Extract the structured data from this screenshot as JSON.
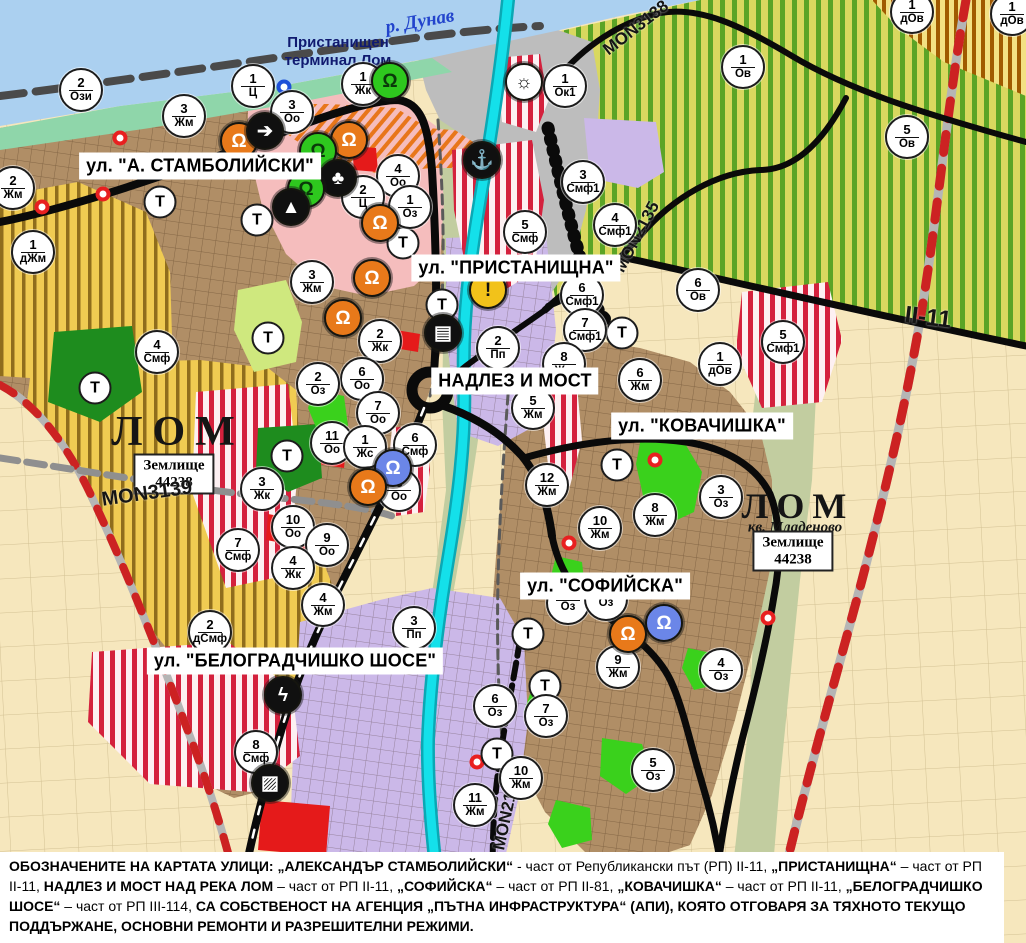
{
  "colors": {
    "base-field": "#f6e7bd",
    "town-brown": "#b08e66",
    "yellow-zone": "#f0cb52",
    "yellow-stripe": "#8f6d1c",
    "vineyard": "#d9d85f",
    "vine-stripe": "#5ba426",
    "brown-zone-bg": "#f3e083",
    "brown-stripe": "#a05a00",
    "pink-zone": "#f5bdbd",
    "orange": "#e8761a",
    "red-zone": "#e51a1a",
    "red-stripe-bg": "#fdf0f2",
    "red-stripe": "#d4213d",
    "lavender": "#cbb8e8",
    "gray-zone": "#bdbdbd",
    "green-dark": "#1e8c1e",
    "green-bright": "#3ad11c",
    "green-light": "#cfe87e",
    "shore": "#8fd6aa",
    "danube": "#abd0f0",
    "valley": "#c2cda0",
    "river-cyan": "#14e0ea",
    "river-teal": "#0aa8b4",
    "road-black": "#0a0a0a",
    "rail-gray": "#b5b5b5",
    "rail-red": "#cc2222",
    "dash-gray": "#8f8f8f",
    "boundary-gray": "#5a5a5a",
    "marker-red": "#e82020",
    "marker-blue": "#1e50d8",
    "danube-text": "#2244cc",
    "port-text": "#101a70"
  },
  "labels": {
    "river": "р. Дунав",
    "port_terminal": "Пристанищен терминал Лом",
    "lom_left": "ЛОМ",
    "lom_right": "ЛОМ",
    "kv_mladenovo": "кв. Младеново",
    "zemlishte_line1": "Землище",
    "zemlishte_line2": "44238"
  },
  "map": {
    "t_label": "Т",
    "street_labels": [
      {
        "id": "stamboliyski",
        "text": "ул. \"А. СТАМБОЛИЙСКИ\"",
        "x": 200,
        "y": 166
      },
      {
        "id": "pristanishtna",
        "text": "ул. \"ПРИСТАНИЩНА\"",
        "x": 516,
        "y": 268
      },
      {
        "id": "nadlez-i-most",
        "text": "НАДЛЕЗ И МОСТ",
        "x": 515,
        "y": 381
      },
      {
        "id": "kovachishka",
        "text": "ул. \"КОВАЧИШКА\"",
        "x": 702,
        "y": 426
      },
      {
        "id": "sofiyska",
        "text": "ул. \"СОФИЙСКА\"",
        "x": 605,
        "y": 586
      },
      {
        "id": "belogradchishko",
        "text": "ул. \"БЕЛОГРАДЧИШКО ШОСЕ\"",
        "x": 295,
        "y": 661
      }
    ],
    "road_labels": [
      {
        "id": "mon3139",
        "text": "MON3139",
        "x": 147,
        "y": 494,
        "rotate": -8,
        "size": 20
      },
      {
        "id": "mon3138",
        "text": "MON3138",
        "x": 636,
        "y": 28,
        "rotate": -38,
        "size": 17
      },
      {
        "id": "mon2135",
        "text": "MON2135",
        "x": 637,
        "y": 237,
        "rotate": -62,
        "size": 17
      },
      {
        "id": "ii-11",
        "text": "II-11",
        "x": 928,
        "y": 318,
        "rotate": 7,
        "size": 24
      },
      {
        "id": "mon2136",
        "text": "MON2136",
        "x": 507,
        "y": 812,
        "rotate": -78,
        "size": 17
      }
    ],
    "zone_markers": [
      {
        "x": 81,
        "y": 90,
        "num": "2",
        "code": "Ози"
      },
      {
        "x": 253,
        "y": 86,
        "num": "1",
        "code": "Ц"
      },
      {
        "x": 292,
        "y": 112,
        "num": "3",
        "code": "Оо"
      },
      {
        "x": 363,
        "y": 84,
        "num": "1",
        "code": "Жк"
      },
      {
        "x": 184,
        "y": 116,
        "num": "3",
        "code": "Жм"
      },
      {
        "x": 13,
        "y": 188,
        "num": "2",
        "code": "Жм"
      },
      {
        "x": 33,
        "y": 252,
        "num": "1",
        "code": "дЖм"
      },
      {
        "x": 398,
        "y": 176,
        "num": "4",
        "code": "Оо"
      },
      {
        "x": 363,
        "y": 197,
        "num": "2",
        "code": "Ц"
      },
      {
        "x": 410,
        "y": 207,
        "num": "1",
        "code": "Оз"
      },
      {
        "x": 565,
        "y": 86,
        "num": "1",
        "code": "Ок1"
      },
      {
        "x": 583,
        "y": 182,
        "num": "3",
        "code": "Смф1"
      },
      {
        "x": 525,
        "y": 232,
        "num": "5",
        "code": "Смф"
      },
      {
        "x": 615,
        "y": 225,
        "num": "4",
        "code": "Смф1"
      },
      {
        "x": 698,
        "y": 290,
        "num": "6",
        "code": "Ов"
      },
      {
        "x": 743,
        "y": 67,
        "num": "1",
        "code": "Ов"
      },
      {
        "x": 907,
        "y": 137,
        "num": "5",
        "code": "Ов"
      },
      {
        "x": 912,
        "y": 12,
        "num": "1",
        "code": "дОв"
      },
      {
        "x": 1012,
        "y": 14,
        "num": "1",
        "code": "дОв"
      },
      {
        "x": 157,
        "y": 352,
        "num": "4",
        "code": "Смф"
      },
      {
        "x": 312,
        "y": 282,
        "num": "3",
        "code": "Жм"
      },
      {
        "x": 380,
        "y": 341,
        "num": "2",
        "code": "Жк"
      },
      {
        "x": 362,
        "y": 379,
        "num": "6",
        "code": "Оо"
      },
      {
        "x": 378,
        "y": 413,
        "num": "7",
        "code": "Оо"
      },
      {
        "x": 318,
        "y": 384,
        "num": "2",
        "code": "Оз"
      },
      {
        "x": 498,
        "y": 348,
        "num": "2",
        "code": "Пп"
      },
      {
        "x": 582,
        "y": 295,
        "num": "6",
        "code": "Смф1"
      },
      {
        "x": 585,
        "y": 330,
        "num": "7",
        "code": "Смф1"
      },
      {
        "x": 564,
        "y": 364,
        "num": "8",
        "code": "Жм"
      },
      {
        "x": 533,
        "y": 408,
        "num": "5",
        "code": "Жм"
      },
      {
        "x": 640,
        "y": 380,
        "num": "6",
        "code": "Жм"
      },
      {
        "x": 262,
        "y": 489,
        "num": "3",
        "code": "Жк"
      },
      {
        "x": 332,
        "y": 443,
        "num": "11",
        "code": "Оо"
      },
      {
        "x": 365,
        "y": 447,
        "num": "1",
        "code": "Жс"
      },
      {
        "x": 415,
        "y": 445,
        "num": "6",
        "code": "Смф"
      },
      {
        "x": 399,
        "y": 490,
        "num": "8",
        "code": "Оо"
      },
      {
        "x": 293,
        "y": 527,
        "num": "10",
        "code": "Оо"
      },
      {
        "x": 327,
        "y": 545,
        "num": "9",
        "code": "Оо"
      },
      {
        "x": 238,
        "y": 550,
        "num": "7",
        "code": "Смф"
      },
      {
        "x": 293,
        "y": 568,
        "num": "4",
        "code": "Жк"
      },
      {
        "x": 547,
        "y": 485,
        "num": "12",
        "code": "Жм"
      },
      {
        "x": 600,
        "y": 528,
        "num": "10",
        "code": "Жм"
      },
      {
        "x": 655,
        "y": 515,
        "num": "8",
        "code": "Жм"
      },
      {
        "x": 721,
        "y": 497,
        "num": "3",
        "code": "Оз"
      },
      {
        "x": 568,
        "y": 603,
        "num": "",
        "code": "Оз"
      },
      {
        "x": 606,
        "y": 599,
        "num": "",
        "code": "Оз"
      },
      {
        "x": 618,
        "y": 667,
        "num": "9",
        "code": "Жм"
      },
      {
        "x": 721,
        "y": 670,
        "num": "4",
        "code": "Оз"
      },
      {
        "x": 495,
        "y": 706,
        "num": "6",
        "code": "Оз"
      },
      {
        "x": 546,
        "y": 716,
        "num": "7",
        "code": "Оз"
      },
      {
        "x": 653,
        "y": 770,
        "num": "5",
        "code": "Оз"
      },
      {
        "x": 521,
        "y": 778,
        "num": "10",
        "code": "Жм"
      },
      {
        "x": 475,
        "y": 805,
        "num": "11",
        "code": "Жм"
      },
      {
        "x": 414,
        "y": 628,
        "num": "3",
        "code": "Пп"
      },
      {
        "x": 323,
        "y": 605,
        "num": "4",
        "code": "Жм"
      },
      {
        "x": 210,
        "y": 632,
        "num": "2",
        "code": "дСмф"
      },
      {
        "x": 256,
        "y": 752,
        "num": "8",
        "code": "Смф"
      },
      {
        "x": 783,
        "y": 342,
        "num": "5",
        "code": "Смф1"
      },
      {
        "x": 720,
        "y": 364,
        "num": "1",
        "code": "дОв"
      }
    ],
    "t_markers": [
      {
        "x": 160,
        "y": 202
      },
      {
        "x": 257,
        "y": 220
      },
      {
        "x": 403,
        "y": 243
      },
      {
        "x": 442,
        "y": 305
      },
      {
        "x": 95,
        "y": 388
      },
      {
        "x": 268,
        "y": 338
      },
      {
        "x": 287,
        "y": 456
      },
      {
        "x": 622,
        "y": 333
      },
      {
        "x": 617,
        "y": 465
      },
      {
        "x": 528,
        "y": 634
      },
      {
        "x": 545,
        "y": 686
      },
      {
        "x": 497,
        "y": 754
      }
    ],
    "icon_styles": {
      "monument-orange": {
        "glyph": "Ω",
        "bg": "#e8791a",
        "fg": "#ffffff"
      },
      "monument-green": {
        "glyph": "Ω",
        "bg": "#2ec81e",
        "fg": "#0a3a0a"
      },
      "monument-blue": {
        "glyph": "Ω",
        "bg": "#6b86e8",
        "fg": "#ffffff"
      },
      "arrow": {
        "glyph": "➔",
        "bg": "#101010",
        "fg": "#ffffff"
      },
      "people": {
        "glyph": "♣",
        "bg": "#101010",
        "fg": "#ffffff"
      },
      "peak": {
        "glyph": "▲",
        "bg": "#101010",
        "fg": "#ffffff"
      },
      "anchor": {
        "glyph": "⚓",
        "bg": "#101010",
        "fg": "#ffffff"
      },
      "harbor-sun": {
        "glyph": "☼",
        "bg": "#ffffff",
        "fg": "#111111"
      },
      "warning": {
        "glyph": "!",
        "bg": "#f2c21a",
        "fg": "#111111"
      },
      "truck": {
        "glyph": "▤",
        "bg": "#101010",
        "fg": "#ffffff"
      },
      "power": {
        "glyph": "ϟ",
        "bg": "#101010",
        "fg": "#ffffff"
      },
      "crossing": {
        "glyph": "▨",
        "bg": "#101010",
        "fg": "#ffffff"
      }
    },
    "icon_markers": [
      {
        "x": 239,
        "y": 141,
        "type": "monument-orange"
      },
      {
        "x": 265,
        "y": 131,
        "type": "arrow"
      },
      {
        "x": 390,
        "y": 81,
        "type": "monument-green"
      },
      {
        "x": 349,
        "y": 140,
        "type": "monument-orange"
      },
      {
        "x": 318,
        "y": 151,
        "type": "monument-green"
      },
      {
        "x": 338,
        "y": 178,
        "type": "people"
      },
      {
        "x": 306,
        "y": 189,
        "type": "monument-green"
      },
      {
        "x": 291,
        "y": 207,
        "type": "peak"
      },
      {
        "x": 380,
        "y": 223,
        "type": "monument-orange"
      },
      {
        "x": 372,
        "y": 278,
        "type": "monument-orange"
      },
      {
        "x": 343,
        "y": 318,
        "type": "monument-orange"
      },
      {
        "x": 393,
        "y": 468,
        "type": "monument-blue"
      },
      {
        "x": 368,
        "y": 487,
        "type": "monument-orange"
      },
      {
        "x": 628,
        "y": 634,
        "type": "monument-orange"
      },
      {
        "x": 664,
        "y": 623,
        "type": "monument-blue"
      },
      {
        "x": 524,
        "y": 82,
        "type": "harbor-sun"
      },
      {
        "x": 482,
        "y": 160,
        "type": "anchor"
      },
      {
        "x": 488,
        "y": 290,
        "type": "warning"
      },
      {
        "x": 443,
        "y": 333,
        "type": "truck"
      },
      {
        "x": 283,
        "y": 695,
        "type": "power"
      },
      {
        "x": 270,
        "y": 783,
        "type": "crossing"
      }
    ],
    "dot_markers": [
      {
        "x": 120,
        "y": 138,
        "color": "red"
      },
      {
        "x": 103,
        "y": 194,
        "color": "red"
      },
      {
        "x": 42,
        "y": 207,
        "color": "red"
      },
      {
        "x": 655,
        "y": 460,
        "color": "red"
      },
      {
        "x": 569,
        "y": 543,
        "color": "red"
      },
      {
        "x": 768,
        "y": 618,
        "color": "red"
      },
      {
        "x": 477,
        "y": 762,
        "color": "red"
      },
      {
        "x": 284,
        "y": 87,
        "color": "blue"
      }
    ]
  },
  "footer": {
    "segments": [
      {
        "t": "ОБОЗНАЧЕНИТЕ НА КАРТАТА УЛИЦИ: „АЛЕКСАНДЪР СТАМБОЛИЙСКИ“",
        "b": true
      },
      {
        "t": " - част от Републикански път (РП) II-11, ",
        "b": false
      },
      {
        "t": "„ПРИСТАНИЩНА“",
        "b": true
      },
      {
        "t": " – част от РП II-11, ",
        "b": false
      },
      {
        "t": "НАДЛЕЗ И МОСТ НАД РЕКА ЛОМ",
        "b": true
      },
      {
        "t": " – част от РП II-11, ",
        "b": false
      },
      {
        "t": "„СОФИЙСКА“",
        "b": true
      },
      {
        "t": " – част от РП II-81, ",
        "b": false
      },
      {
        "t": "„КОВАЧИШКА“",
        "b": true
      },
      {
        "t": " – част от РП II-11, ",
        "b": false
      },
      {
        "t": "„БЕЛОГРАДЧИШКО ШОСЕ“",
        "b": true
      },
      {
        "t": " – част от РП III-114, ",
        "b": false
      },
      {
        "t": "СА СОБСТВЕНОСТ НА АГЕНЦИЯ „ПЪТНА ИНФРАСТРУКТУРА“ (АПИ), КОЯТО ОТГОВАРЯ ЗА ТЯХНОТО ТЕКУЩО ПОДДЪРЖАНЕ, ОСНОВНИ РЕМОНТИ И РАЗРЕШИТЕЛНИ РЕЖИМИ.",
        "b": true
      }
    ]
  }
}
